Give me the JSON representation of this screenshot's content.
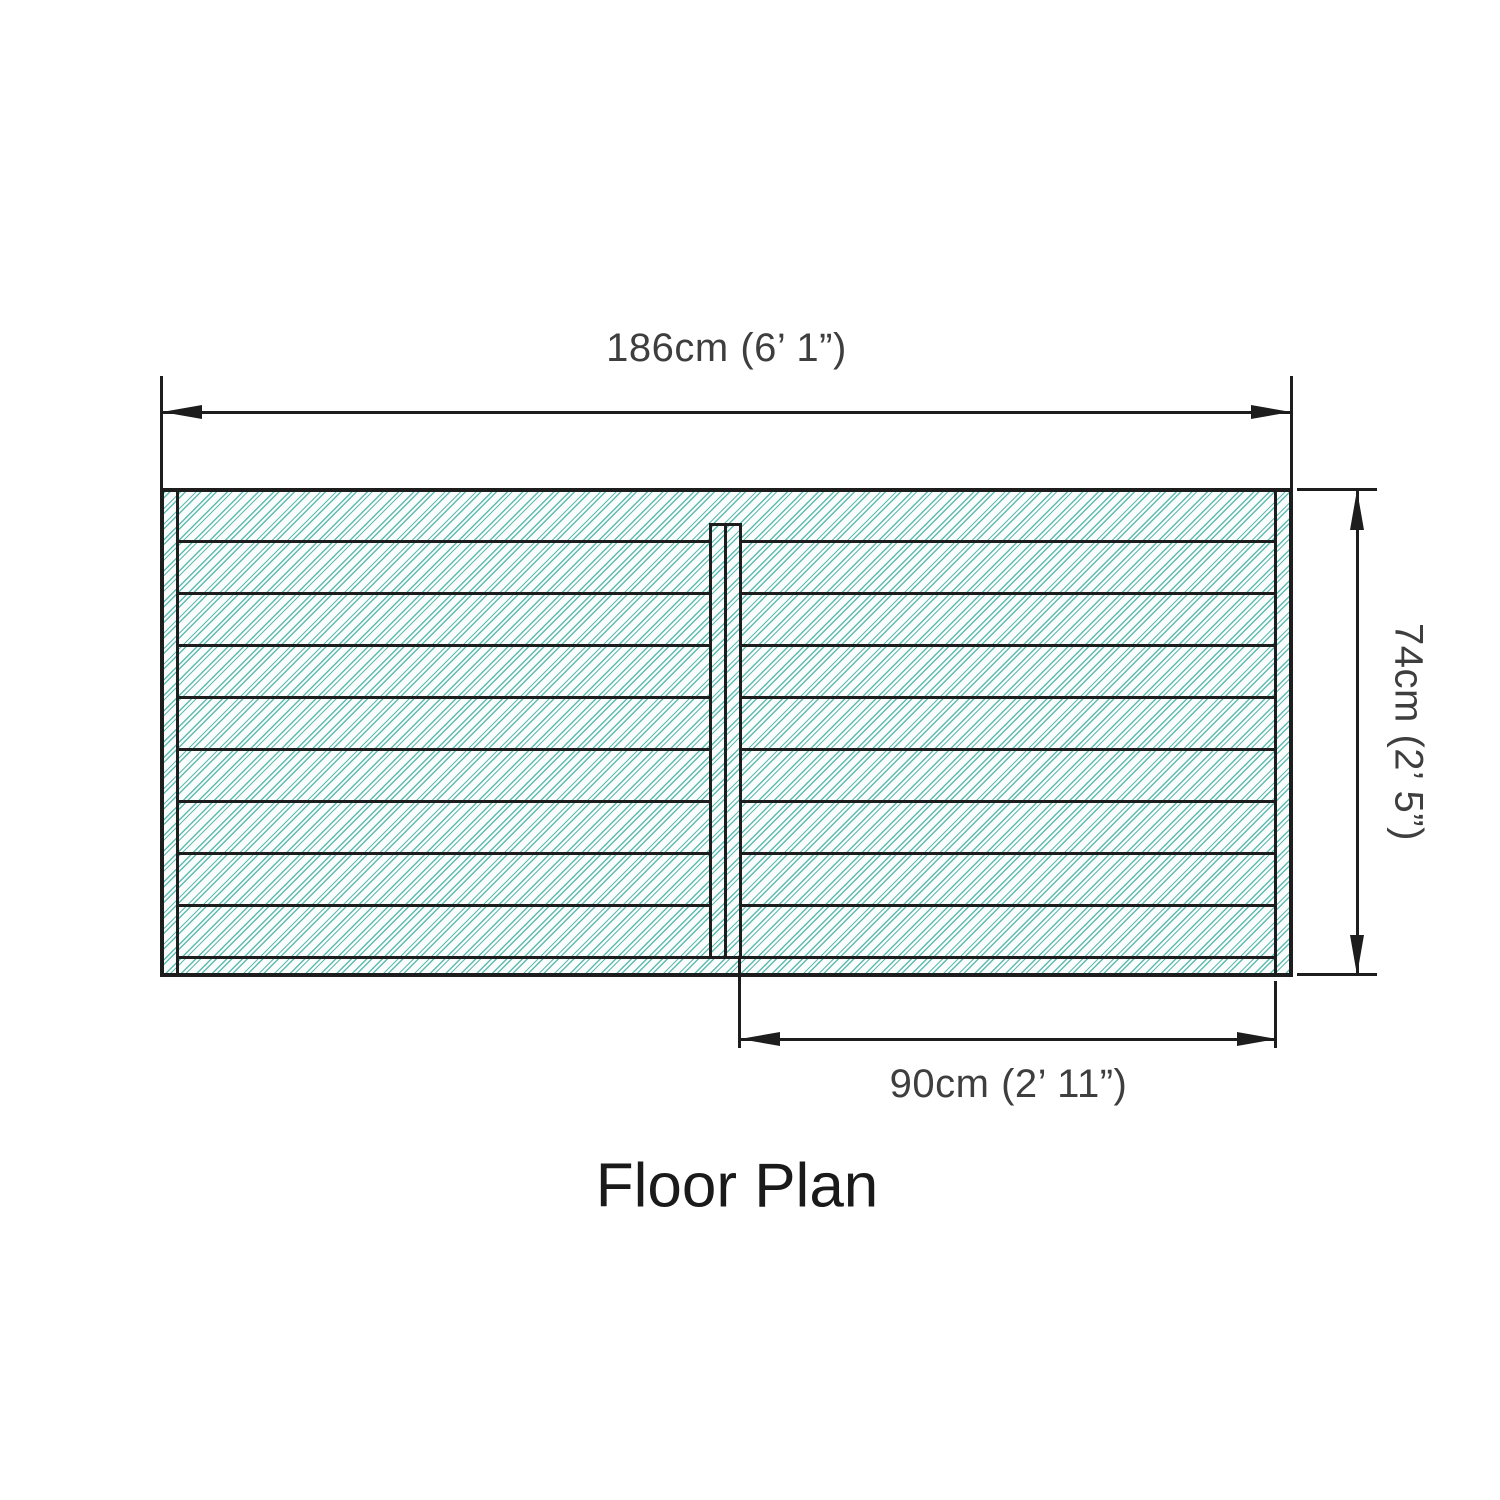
{
  "title": "Floor Plan",
  "dimensions": {
    "width": {
      "label": "186cm (6’ 1”)"
    },
    "height": {
      "label": "74cm (2’ 5”)"
    },
    "opening": {
      "label": "90cm (2’ 11”)"
    }
  },
  "plan": {
    "board_count": 9,
    "has_left_edge_strip": true,
    "has_right_edge_strip": true,
    "has_bottom_edge_strip": true,
    "has_center_divider": true
  },
  "colors": {
    "hatch": "#5fbcb2",
    "line": "#1d1d1d",
    "text": "#3e3e3e"
  }
}
